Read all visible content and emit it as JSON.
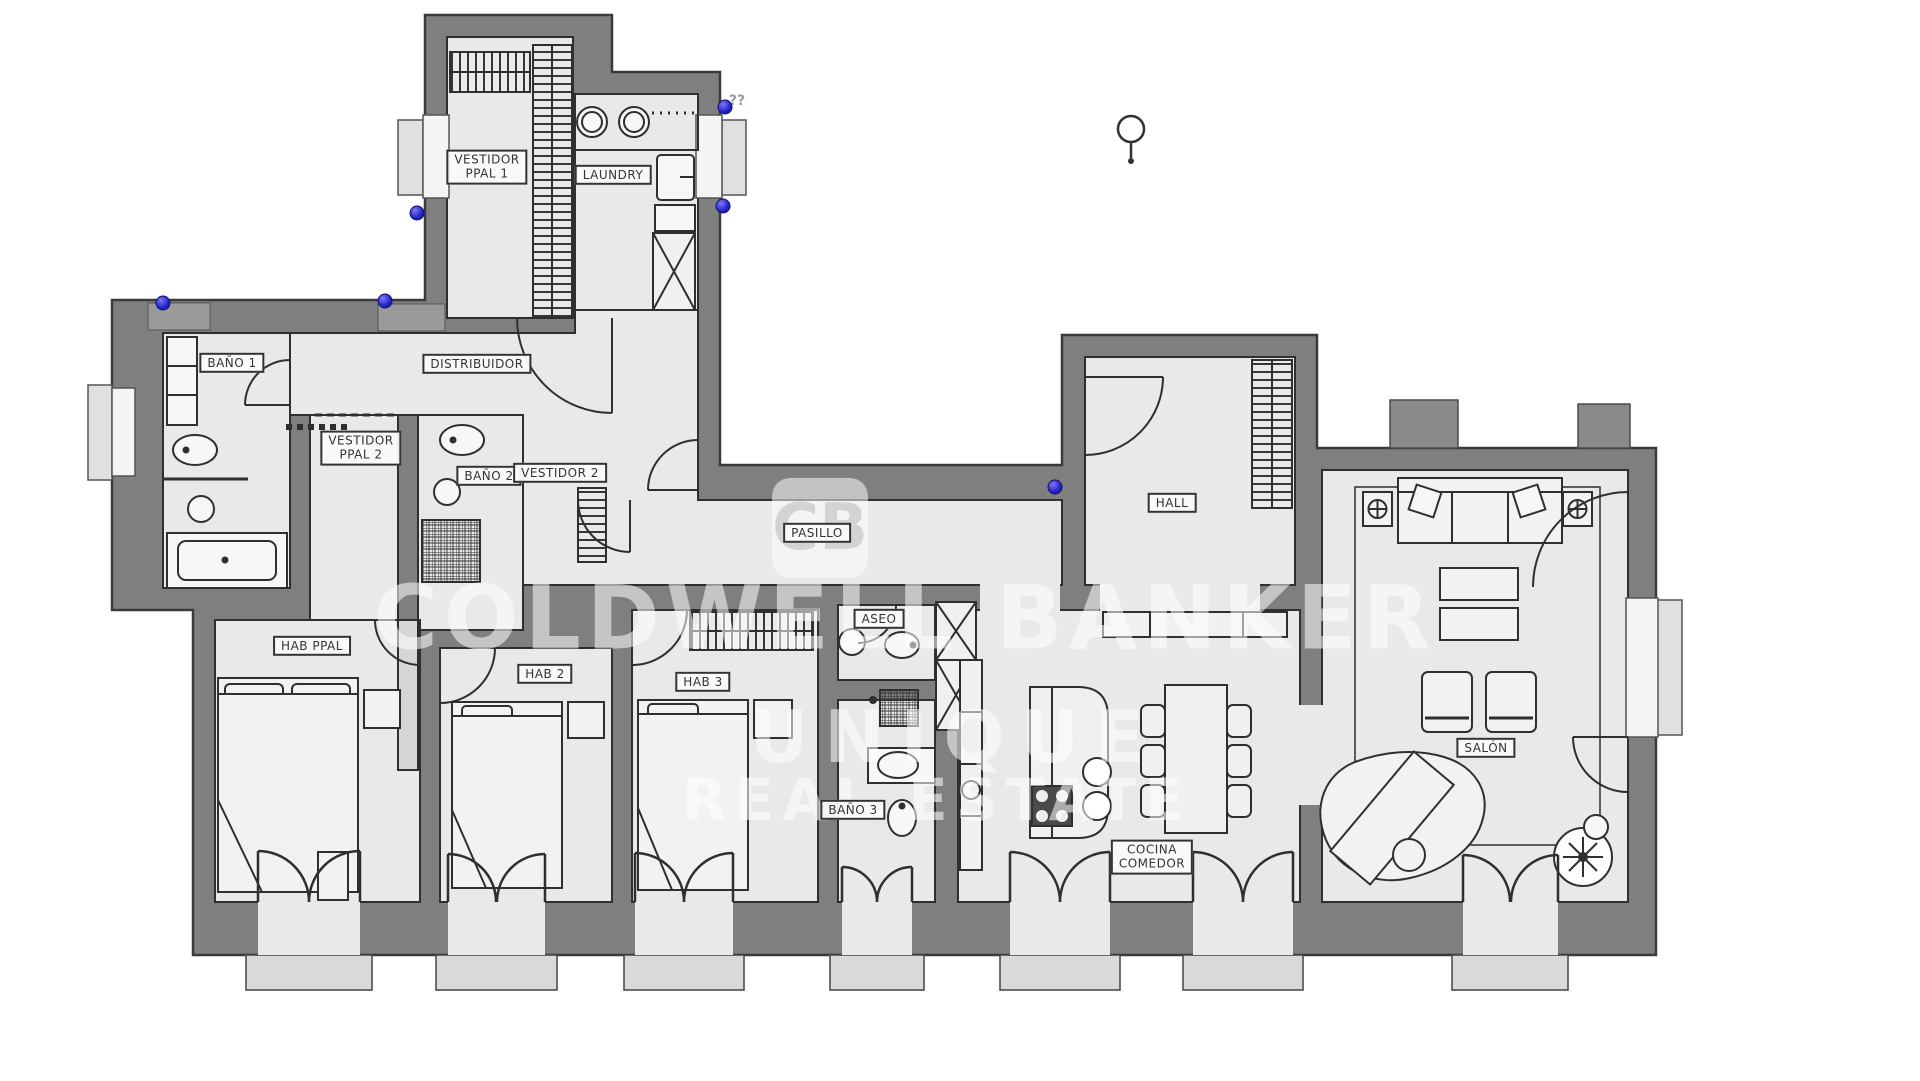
{
  "canvas": {
    "width": 1920,
    "height": 1081
  },
  "colors": {
    "wall": "#7f7f7f",
    "floor": "#e9e9e9",
    "line": "#2f2f2f",
    "marker_blue": "#2222c8",
    "watermark": "rgba(255,255,255,0.55)"
  },
  "watermark": {
    "logo_text": "CB",
    "line1": "COLDWELL BANKER",
    "line2": "UNIQUE",
    "line3": "REAL ESTATE"
  },
  "annotations": {
    "unknown_note": "??"
  },
  "plan": {
    "rooms": [
      {
        "id": "vestidor-ppal-1",
        "lines": [
          "VESTIDOR",
          "PPAL 1"
        ],
        "x": 487,
        "y": 167
      },
      {
        "id": "laundry",
        "lines": [
          "LAUNDRY"
        ],
        "x": 613,
        "y": 175
      },
      {
        "id": "bano-1",
        "lines": [
          "BAÑO 1"
        ],
        "x": 232,
        "y": 363
      },
      {
        "id": "distribuidor",
        "lines": [
          "DISTRIBUIDOR"
        ],
        "x": 477,
        "y": 364
      },
      {
        "id": "vestidor-ppal-2",
        "lines": [
          "VESTIDOR",
          "PPAL 2"
        ],
        "x": 361,
        "y": 448
      },
      {
        "id": "bano-2",
        "lines": [
          "BAÑO 2"
        ],
        "x": 489,
        "y": 476
      },
      {
        "id": "vestidor-2",
        "lines": [
          "VESTIDOR 2"
        ],
        "x": 560,
        "y": 473
      },
      {
        "id": "pasillo",
        "lines": [
          "PASILLO"
        ],
        "x": 817,
        "y": 533
      },
      {
        "id": "hall",
        "lines": [
          "HALL"
        ],
        "x": 1172,
        "y": 503
      },
      {
        "id": "hab-ppal",
        "lines": [
          "HAB PPAL"
        ],
        "x": 312,
        "y": 646
      },
      {
        "id": "hab-2",
        "lines": [
          "HAB 2"
        ],
        "x": 545,
        "y": 674
      },
      {
        "id": "hab-3",
        "lines": [
          "HAB 3"
        ],
        "x": 703,
        "y": 682
      },
      {
        "id": "aseo",
        "lines": [
          "ASEO"
        ],
        "x": 879,
        "y": 619
      },
      {
        "id": "bano-3",
        "lines": [
          "BAÑO 3"
        ],
        "x": 853,
        "y": 810
      },
      {
        "id": "cocina-comedor",
        "lines": [
          "COCINA",
          "COMEDOR"
        ],
        "x": 1152,
        "y": 857
      },
      {
        "id": "salon",
        "lines": [
          "SALÓN"
        ],
        "x": 1486,
        "y": 748
      }
    ],
    "markers": [
      {
        "x": 163,
        "y": 303
      },
      {
        "x": 385,
        "y": 301
      },
      {
        "x": 417,
        "y": 213
      },
      {
        "x": 725,
        "y": 107
      },
      {
        "x": 723,
        "y": 206
      },
      {
        "x": 1055,
        "y": 487
      }
    ]
  }
}
